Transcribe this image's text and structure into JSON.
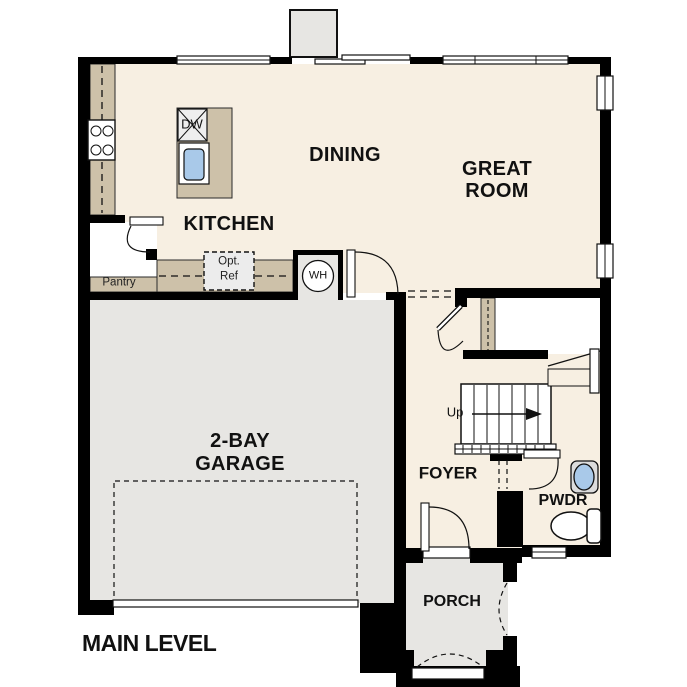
{
  "title": "MAIN LEVEL",
  "rooms": {
    "kitchen": "KITCHEN",
    "dining": "DINING",
    "great_room_1": "GREAT",
    "great_room_2": "ROOM",
    "garage_1": "2-BAY",
    "garage_2": "GARAGE",
    "foyer": "FOYER",
    "powder_room": "PWDR",
    "porch": "PORCH",
    "pantry": "Pantry"
  },
  "labels": {
    "dishwasher": "DW",
    "water_heater": "WH",
    "optional_fridge_1": "Opt.",
    "optional_fridge_2": "Ref",
    "stair_direction": "Up"
  },
  "colors": {
    "wall": "#000000",
    "interior": "#f7efe2",
    "counter": "#cdc1a9",
    "concrete": "#e7e6e3",
    "fixture_blue": "#a9c9e9",
    "background": "#ffffff",
    "text": "#111111"
  }
}
